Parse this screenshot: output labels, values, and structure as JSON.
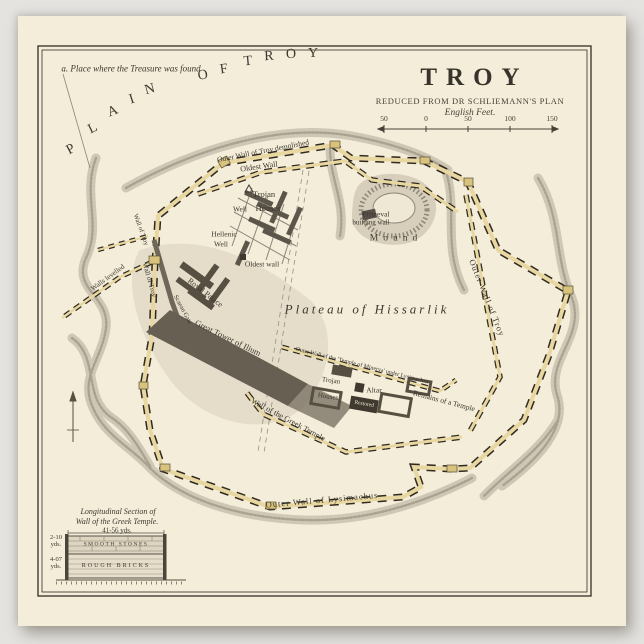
{
  "colors": {
    "paper": "#f4edda",
    "ink": "#3d382f",
    "wall_tan": "#e8d7a0",
    "wall_dash": "#2f2a21",
    "ravine_grey": "#a69d8b",
    "block_dark": "#574f42",
    "gate_gold": "#d9c37c"
  },
  "title": {
    "main": "TROY",
    "subtitle": "REDUCED FROM DR SCHLIEMANN'S PLAN",
    "scale_caption": "English Feet.",
    "scale_ticks": [
      "50",
      "0",
      "50",
      "100",
      "150"
    ]
  },
  "labels": [
    {
      "id": "treasure-note",
      "t": "a. Place where the Treasure was found",
      "x": 131,
      "y": 69,
      "s": 9,
      "i": true
    },
    {
      "id": "plain-letter-p",
      "t": "P",
      "x": 71,
      "y": 150,
      "r": -28,
      "s": 14
    },
    {
      "id": "plain-letter-l",
      "t": "L",
      "x": 93,
      "y": 129,
      "r": -26,
      "s": 14
    },
    {
      "id": "plain-letter-a",
      "t": "A",
      "x": 113,
      "y": 112,
      "r": -22,
      "s": 14
    },
    {
      "id": "plain-letter-i",
      "t": "I",
      "x": 132,
      "y": 100,
      "r": -18,
      "s": 14
    },
    {
      "id": "plain-letter-n",
      "t": "N",
      "x": 150,
      "y": 90,
      "r": -15,
      "s": 14
    },
    {
      "id": "plain-letter-o1",
      "t": "O",
      "x": 203,
      "y": 76,
      "r": -10,
      "s": 14
    },
    {
      "id": "plain-letter-f",
      "t": "F",
      "x": 224,
      "y": 70,
      "r": -8,
      "s": 14
    },
    {
      "id": "plain-letter-t",
      "t": "T",
      "x": 248,
      "y": 62,
      "r": -5,
      "s": 14
    },
    {
      "id": "plain-letter-r",
      "t": "R",
      "x": 269,
      "y": 57,
      "r": -3,
      "s": 14
    },
    {
      "id": "plain-letter-o2",
      "t": "O",
      "x": 291,
      "y": 55,
      "r": -1,
      "s": 14
    },
    {
      "id": "plain-letter-y",
      "t": "Y",
      "x": 313,
      "y": 54,
      "r": 0,
      "s": 14
    },
    {
      "id": "outer-wall-demolished",
      "t": "Outer Wall of Troy demolished",
      "x": 263,
      "y": 151,
      "r": -11,
      "s": 7.5
    },
    {
      "id": "oldest-wall-top",
      "t": "Oldest Wall",
      "x": 259,
      "y": 167,
      "r": -8,
      "s": 8
    },
    {
      "id": "trojan-1",
      "t": "Trojan",
      "x": 264,
      "y": 194,
      "s": 8.5
    },
    {
      "id": "well-1",
      "t": "Well",
      "x": 240,
      "y": 209,
      "s": 7.5
    },
    {
      "id": "houses-1",
      "t": "Houses",
      "x": 268,
      "y": 208,
      "s": 8.5
    },
    {
      "id": "hellenic",
      "t": "Hellenic",
      "x": 224,
      "y": 234,
      "s": 7.5
    },
    {
      "id": "hellenic-well",
      "t": "Well",
      "x": 221,
      "y": 244,
      "s": 7.5
    },
    {
      "id": "primeval",
      "t": "Primeval",
      "x": 376,
      "y": 214,
      "s": 7.5
    },
    {
      "id": "building-wall",
      "t": "building wall",
      "x": 371,
      "y": 223,
      "s": 7
    },
    {
      "id": "mound",
      "t": "Mound",
      "x": 396,
      "y": 239,
      "s": 9.5,
      "ls": 5
    },
    {
      "id": "oldest-wall-2",
      "t": "Oldest wall",
      "x": 262,
      "y": 264,
      "s": 7.5
    },
    {
      "id": "plateau",
      "t": "Plateau of Hissarlik",
      "x": 367,
      "y": 309,
      "s": 13,
      "i": true,
      "ls": 3
    },
    {
      "id": "minerva-wall",
      "t": "Outer Wall of the 'Temple of Minerva' under Lysimachus",
      "x": 362,
      "y": 366,
      "r": 14,
      "s": 6
    },
    {
      "id": "remains-temple",
      "t": "Remains of a Temple",
      "x": 444,
      "y": 401,
      "r": 15,
      "s": 7.5
    },
    {
      "id": "altar",
      "t": "Altar",
      "x": 374,
      "y": 390,
      "s": 7.5
    },
    {
      "id": "trojan-2",
      "t": "Trojan",
      "x": 331,
      "y": 381,
      "r": 8,
      "s": 7
    },
    {
      "id": "houses-2",
      "t": "Houses",
      "x": 328,
      "y": 397,
      "r": 8,
      "s": 7
    },
    {
      "id": "restored",
      "t": "Restored",
      "x": 364,
      "y": 405,
      "r": 10,
      "s": 5.5,
      "c": "#ece4cf"
    },
    {
      "id": "greek-temple-wall",
      "t": "Wall of the Greek Temple",
      "x": 288,
      "y": 420,
      "r": 28,
      "s": 8
    },
    {
      "id": "great-tower",
      "t": "Great Tower of Ilium",
      "x": 228,
      "y": 338,
      "r": 26,
      "s": 8.5
    },
    {
      "id": "royal-palace",
      "t": "Royal Palace",
      "x": 205,
      "y": 293,
      "r": 38,
      "s": 8
    },
    {
      "id": "scaean-gate",
      "t": "Scaean Gate",
      "x": 182,
      "y": 310,
      "r": 62,
      "s": 6.5
    },
    {
      "id": "walls-levelled",
      "t": "Walls levelled",
      "x": 108,
      "y": 278,
      "r": -36,
      "s": 7
    },
    {
      "id": "wall-of-troy-mid",
      "t": "Wall of Troy",
      "x": 149,
      "y": 280,
      "r": 74,
      "s": 7
    },
    {
      "id": "wall-of-troy-left",
      "t": "Wall of Troy",
      "x": 140,
      "y": 230,
      "r": 70,
      "s": 6.5
    },
    {
      "id": "outer-wall-right",
      "t": "Outer Wall of Troy",
      "x": 487,
      "y": 298,
      "r": 68,
      "s": 8.5,
      "ls": 1
    },
    {
      "id": "outer-wall-lysimachus",
      "t": "Outer Wall of Lysimachus",
      "x": 322,
      "y": 500,
      "r": -5,
      "s": 8.5,
      "ls": 1
    },
    {
      "id": "section-title-1",
      "t": "Longitudinal Section of",
      "x": 118,
      "y": 512,
      "s": 8,
      "i": true
    },
    {
      "id": "section-title-2",
      "t": "Wall of the Greek Temple.",
      "x": 117,
      "y": 522,
      "s": 8,
      "i": true
    },
    {
      "id": "section-width",
      "t": "41-56 yds.",
      "x": 117,
      "y": 531,
      "s": 7
    },
    {
      "id": "smooth-stones",
      "t": "SMOOTH STONES",
      "x": 116,
      "y": 545,
      "s": 5.5,
      "ls": 1.5,
      "c": "#3f3a31"
    },
    {
      "id": "rough-bricks",
      "t": "ROUGH BRICKS",
      "x": 116,
      "y": 566,
      "s": 6,
      "ls": 2,
      "c": "#3f3a31"
    },
    {
      "id": "dim-top-num",
      "t": "2-10",
      "x": 56,
      "y": 538,
      "s": 6.5
    },
    {
      "id": "dim-top-unit",
      "t": "yds.",
      "x": 56,
      "y": 545,
      "s": 6.5
    },
    {
      "id": "dim-bot-num",
      "t": "4-07",
      "x": 56,
      "y": 560,
      "s": 6.5
    },
    {
      "id": "dim-bot-unit",
      "t": "yds.",
      "x": 56,
      "y": 567,
      "s": 6.5
    }
  ]
}
